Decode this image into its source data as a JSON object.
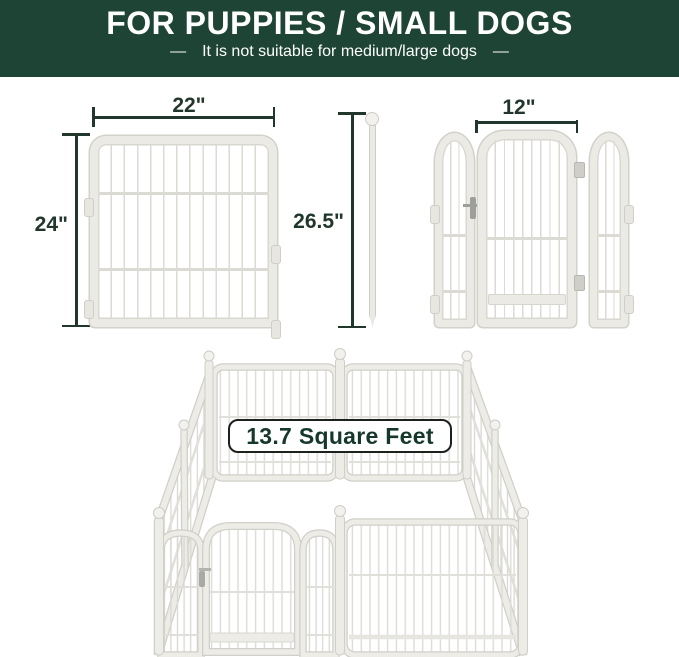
{
  "header": {
    "title": "FOR PUPPIES / SMALL DOGS",
    "subtitle": "It is not suitable for medium/large dogs",
    "dash": "—"
  },
  "dimensions": {
    "panel_width": "22\"",
    "panel_height": "24\"",
    "pole_height": "26.5\"",
    "door_width": "12\""
  },
  "pen": {
    "area_label": "13.7 Square Feet"
  },
  "colors": {
    "header_bg": "#1d4434",
    "ink": "#22372c",
    "panel_frame": "#eceae5",
    "panel_outline": "#d2d1ca",
    "bar": "#dbdad3",
    "badge_border": "#1d211e",
    "badge_text": "#16382a"
  }
}
